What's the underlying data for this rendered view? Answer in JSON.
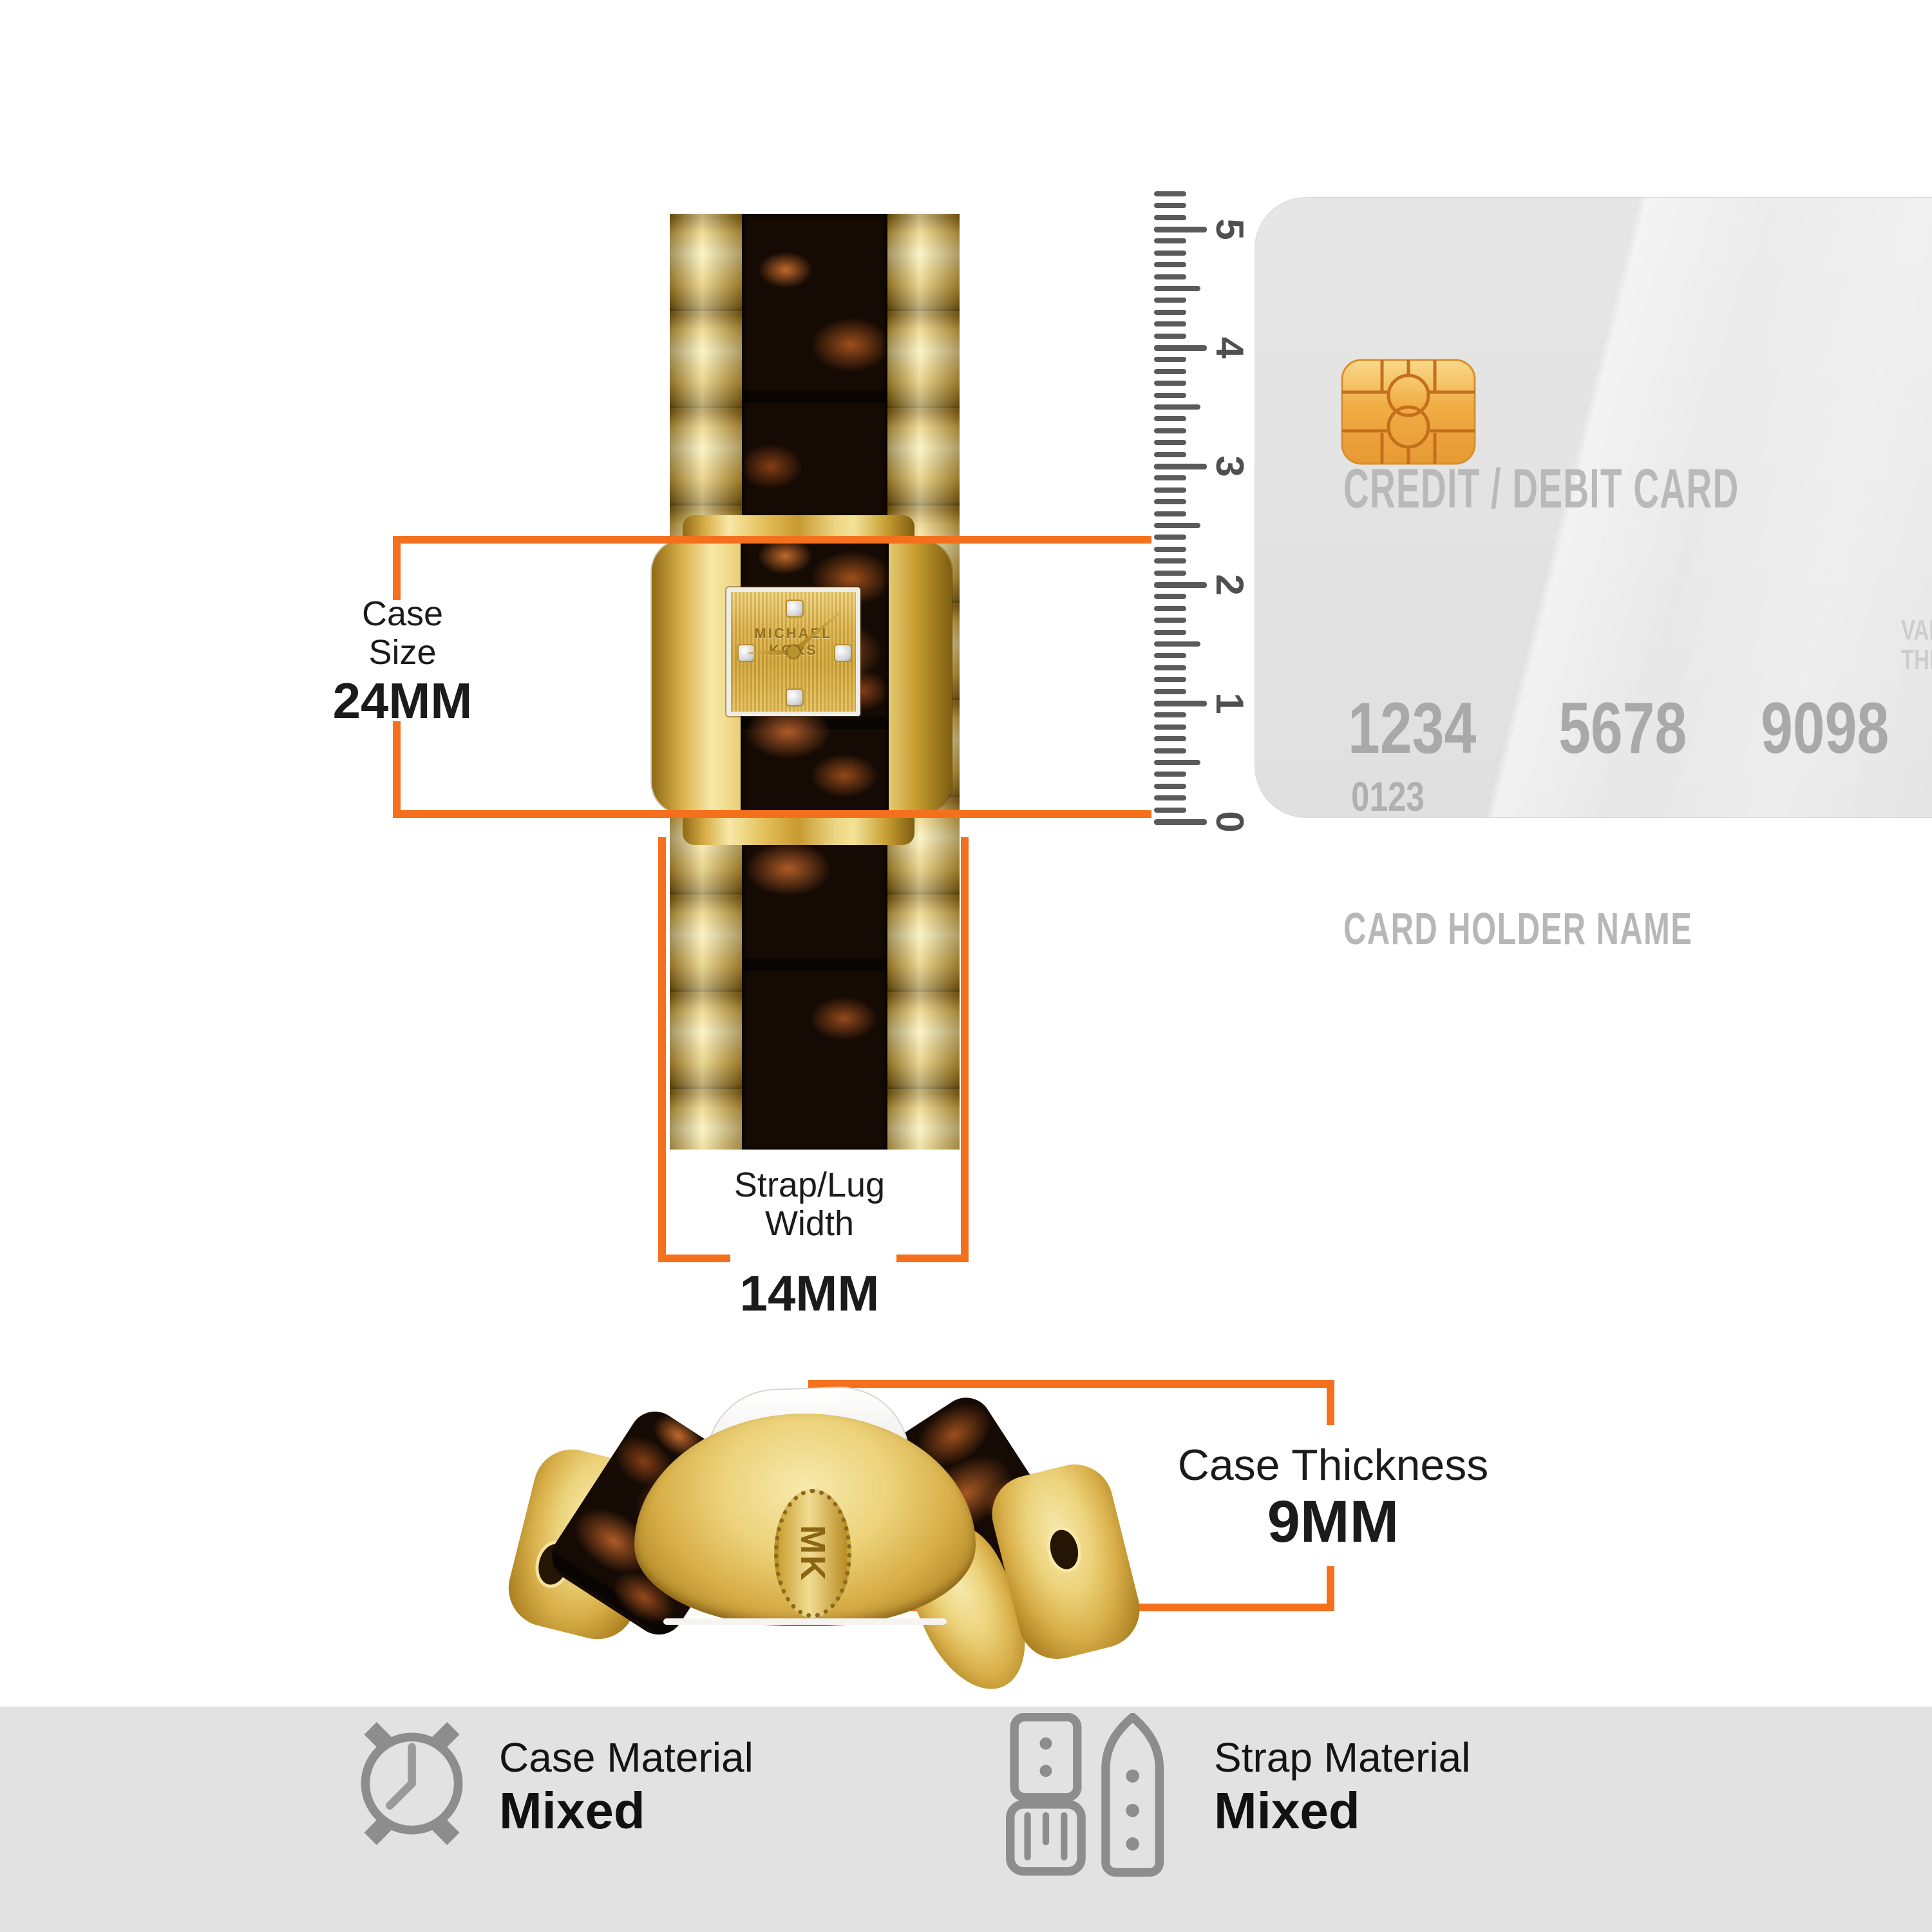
{
  "colors": {
    "accent": "#f4701d",
    "footer_bg": "#e2e2e2",
    "gold": "#d9b04a",
    "tortoise": "#160b04",
    "card_gray": "#e3e3e3",
    "icon_gray": "#8d8d8d",
    "ruler_gray": "#5a5a5a"
  },
  "annotations": {
    "case_size": {
      "label": [
        "Case",
        "Size"
      ],
      "value": "24MM"
    },
    "strap_width": {
      "label": [
        "Strap/Lug",
        "Width"
      ],
      "value": "14MM"
    },
    "case_thickness": {
      "label": "Case Thickness",
      "value": "9MM"
    }
  },
  "ruler": {
    "numbers": [
      "0",
      "1",
      "2",
      "3",
      "4",
      "5"
    ],
    "unit": "cm"
  },
  "scale_arrow": {
    "label": "54mm"
  },
  "card": {
    "title": "CREDIT / DEBIT CARD",
    "numbers": [
      "1234",
      "5678",
      "9098"
    ],
    "issue": "0123",
    "holder": "CARD HOLDER NAME",
    "valid": [
      "VAL",
      "THR"
    ]
  },
  "watch": {
    "brand": "MICHAEL KORS",
    "crown": "MK"
  },
  "footer": [
    {
      "icon": "watch-case-icon",
      "label": "Case Material",
      "value": "Mixed"
    },
    {
      "icon": "watch-straps-icon",
      "label": "Strap Material",
      "value": "Mixed"
    }
  ]
}
